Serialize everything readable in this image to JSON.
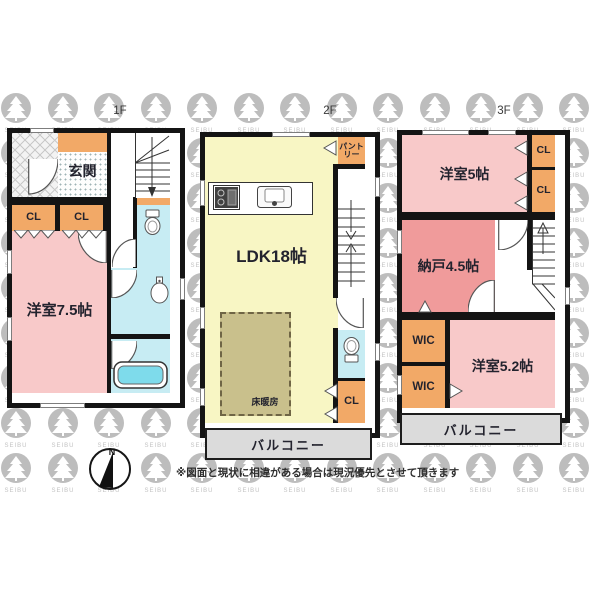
{
  "page": {
    "watermark_text": "SEIBU",
    "disclaimer": "※図面と現状に相違がある場合は現況優先とさせて頂きます",
    "compass_north_label": "N"
  },
  "floors": [
    {
      "label": "1F",
      "rooms": {
        "genkan": "玄関",
        "closet_left": "CL",
        "closet_right": "CL",
        "bedroom": "洋室7.5帖"
      }
    },
    {
      "label": "2F",
      "rooms": {
        "pantry": "パントリー",
        "ldk": "LDK18帖",
        "floor_heating": "床暖房",
        "closet": "CL",
        "balcony": "バルコニー"
      }
    },
    {
      "label": "3F",
      "rooms": {
        "bedroom_5": "洋室5帖",
        "closet_top": "CL",
        "closet_bottom": "CL",
        "storage": "納戸4.5帖",
        "wic_top": "WIC",
        "wic_bottom": "WIC",
        "bedroom_52": "洋室5.2帖",
        "balcony": "バルコニー"
      }
    }
  ]
}
